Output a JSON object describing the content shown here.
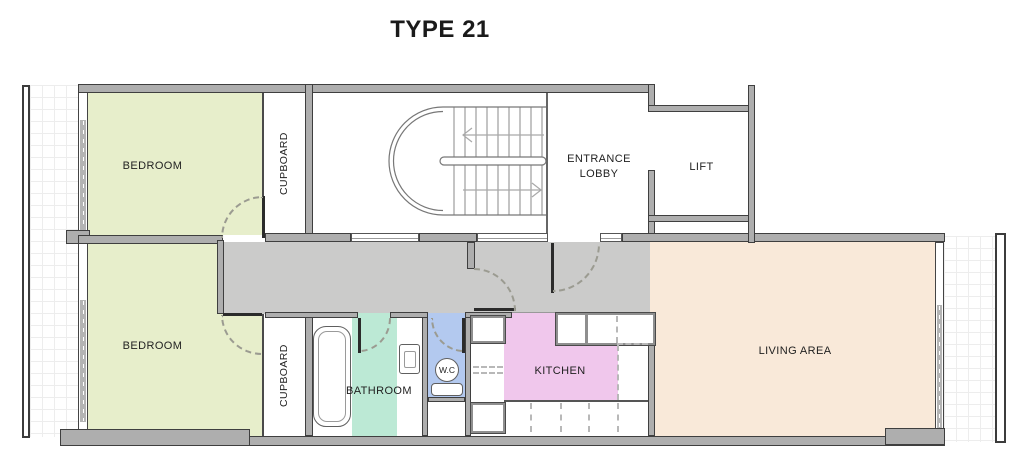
{
  "title": "TYPE 21",
  "rooms": {
    "bedroom_top": {
      "label": "BEDROOM",
      "color": "#e7eecb"
    },
    "bedroom_bottom": {
      "label": "BEDROOM",
      "color": "#e7eecb"
    },
    "cupboard_top": {
      "label": "CUPBOARD",
      "color": "#ffffff"
    },
    "cupboard_bottom": {
      "label": "CUPBOARD",
      "color": "#ffffff"
    },
    "entrance_lobby": {
      "label": "ENTRANCE LOBBY",
      "color": "#ffffff"
    },
    "lift": {
      "label": "LIFT",
      "color": "#ffffff"
    },
    "corridor": {
      "label": "",
      "color": "#cbcbca"
    },
    "bathroom": {
      "label": "BATHROOM",
      "color": "#bce9d5"
    },
    "wc": {
      "label": "W.C",
      "color": "#b3c9ef"
    },
    "kitchen": {
      "label": "KITCHEN",
      "color": "#f0c7ec"
    },
    "living_area": {
      "label": "LIVING AREA",
      "color": "#f9e9d9"
    }
  },
  "palette": {
    "wall_fill": "#aeaeae",
    "wall_outline": "#3f3f3f",
    "door_arc": "#9b9b91",
    "grid_line": "#ededed",
    "title_color": "#1a1a1a",
    "label_color": "#1f1f1f"
  }
}
